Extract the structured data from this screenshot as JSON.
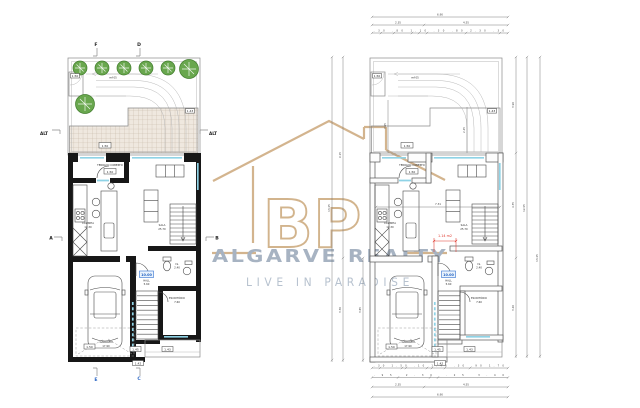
{
  "watermark": {
    "monogram": "BP",
    "brand": "ALGARVE REALTY",
    "tagline": "LIVE IN PARADISE",
    "accent": "#cfae84",
    "brand_color": "#a7b3c2",
    "tagline_color": "#b7c2cf"
  },
  "markers": {
    "f": "F",
    "d": "D",
    "e": "E",
    "c": "C",
    "a": "A",
    "b": "B",
    "alt_left": "ALT",
    "alt_right": "ALT"
  },
  "rooms": {
    "terrace": {
      "label": "TERRAÇO COBERTO",
      "area": "6.00"
    },
    "kitchen": {
      "label": "COZINHA",
      "area": "12.30"
    },
    "living": {
      "label": "SALA",
      "area": "25.70"
    },
    "garage": {
      "label": "GARAGEM",
      "area": "17.90"
    },
    "hall": {
      "label": "HALL",
      "area": "5.60"
    },
    "wc": {
      "label": "I.S.",
      "area": "2.40"
    },
    "office": {
      "label": "ESCRITÓRIO",
      "area": "7.60"
    },
    "driveway_note": "ref 05"
  },
  "levels": {
    "gate": "1.50",
    "tile": "1.50",
    "tile_edge": "1.43",
    "terrace": "1.50",
    "garage": "1.50",
    "hall_badge": "10.00",
    "porch_a": "1.45",
    "porch_b": "1.43",
    "entry_step": "1.42"
  },
  "dims": {
    "top1": "6.90",
    "top2a": "2.35",
    "top2b": "4.55",
    "top3": ".30 .80 1.10 .30 .80 2.30 .30",
    "bot1": ".30 1.50 .10 1.40 .30 .90 1.70",
    "bot2": ".95 2.30 .25 3.40",
    "bot3a": "2.35",
    "bot3b": "4.55",
    "bot4": "6.90",
    "left1": "13.45",
    "left2a": "9.15",
    "left2b": "3.30",
    "left3": "3.65",
    "right1": "12.95",
    "right2a": "3.90",
    "right2b": "4.35",
    "right2c": "3.40",
    "right3": "13.45",
    "inner_w": "7.31",
    "inner_h1": "3.95",
    "inner_h2": "2.45",
    "red_note": "1.14 m2"
  }
}
